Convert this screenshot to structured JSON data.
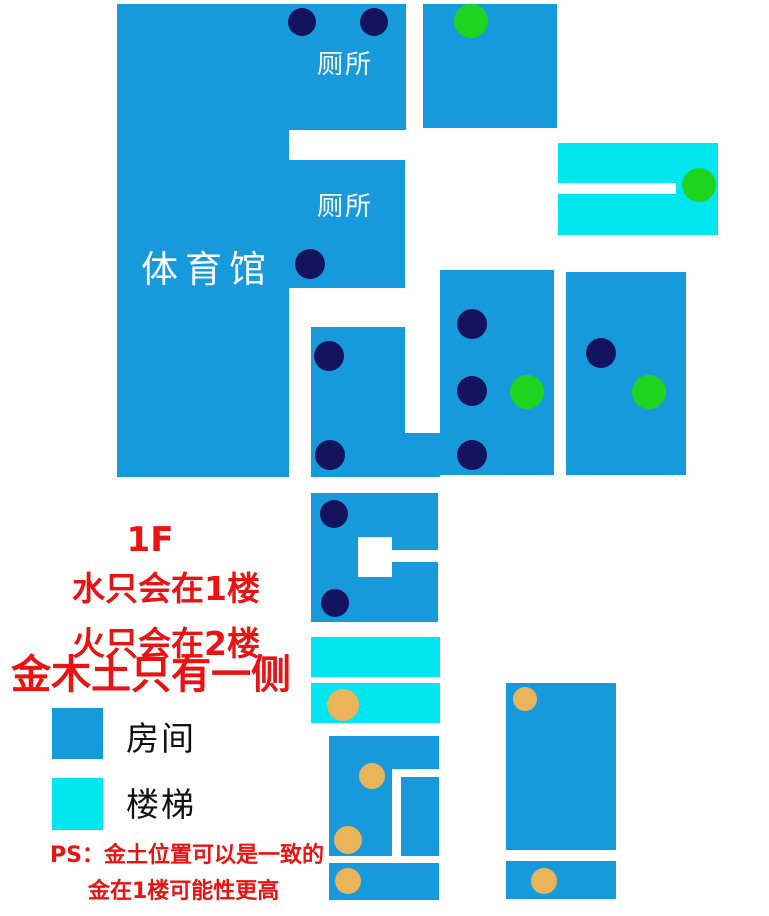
{
  "map": {
    "width": 769,
    "height": 916,
    "colors": {
      "room": "#169ADB",
      "stair": "#00E6EF",
      "cutout": "#FFFFFF",
      "navy": "#14145E",
      "green": "#1ED41E",
      "orange": "#E9B45A",
      "note_red": "#EA1212",
      "label_white": "#FFFFFF",
      "label_black": "#111111"
    },
    "labels": {
      "gym": "体育馆",
      "toilet_top": "厕所",
      "toilet_mid": "厕所"
    },
    "shapes": [
      {
        "name": "room-gym-main",
        "fill": "room",
        "x": 117,
        "y": 4,
        "w": 172,
        "h": 473
      },
      {
        "name": "room-gym-wing-top",
        "fill": "room",
        "x": 289,
        "y": 4,
        "w": 117,
        "h": 126
      },
      {
        "name": "room-gym-wing-mid",
        "fill": "room",
        "x": 289,
        "y": 160,
        "w": 116,
        "h": 128
      },
      {
        "name": "room-top-right",
        "fill": "room",
        "x": 423,
        "y": 4,
        "w": 134,
        "h": 124
      },
      {
        "name": "stair-top-right",
        "fill": "stair",
        "x": 558,
        "y": 143,
        "w": 160,
        "h": 92
      },
      {
        "name": "room-mid-left",
        "fill": "room",
        "x": 311,
        "y": 327,
        "w": 129,
        "h": 150
      },
      {
        "name": "room-mid-center",
        "fill": "room",
        "x": 440,
        "y": 270,
        "w": 114,
        "h": 205
      },
      {
        "name": "room-mid-right",
        "fill": "room",
        "x": 566,
        "y": 272,
        "w": 120,
        "h": 203
      },
      {
        "name": "room-lower-left",
        "fill": "room",
        "x": 311,
        "y": 493,
        "w": 127,
        "h": 129
      },
      {
        "name": "stair-mid-upper",
        "fill": "stair",
        "x": 311,
        "y": 637,
        "w": 129,
        "h": 40
      },
      {
        "name": "stair-mid-lower",
        "fill": "stair",
        "x": 311,
        "y": 683,
        "w": 129,
        "h": 40
      },
      {
        "name": "room-bottom-left",
        "fill": "room",
        "x": 329,
        "y": 736,
        "w": 110,
        "h": 120
      },
      {
        "name": "room-bottom-left-strip",
        "fill": "room",
        "x": 329,
        "y": 863,
        "w": 110,
        "h": 37
      },
      {
        "name": "room-bottom-right",
        "fill": "room",
        "x": 506,
        "y": 683,
        "w": 110,
        "h": 167
      },
      {
        "name": "room-bottom-right-strip",
        "fill": "room",
        "x": 506,
        "y": 861,
        "w": 110,
        "h": 38
      },
      {
        "name": "cutout-mid-left-channel",
        "fill": "cutout",
        "x": 405,
        "y": 327,
        "w": 35,
        "h": 106
      },
      {
        "name": "cutout-stair-slot",
        "fill": "cutout",
        "x": 558,
        "y": 183,
        "w": 118,
        "h": 11
      },
      {
        "name": "cutout-lower-left-square",
        "fill": "cutout",
        "x": 358,
        "y": 537,
        "w": 34,
        "h": 40
      },
      {
        "name": "cutout-lower-left-slot",
        "fill": "cutout",
        "x": 392,
        "y": 550,
        "w": 46,
        "h": 12
      },
      {
        "name": "cutout-bottom-left-slot-h",
        "fill": "cutout",
        "x": 392,
        "y": 769,
        "w": 47,
        "h": 8
      },
      {
        "name": "cutout-bottom-left-slot-v",
        "fill": "cutout",
        "x": 392,
        "y": 777,
        "w": 9,
        "h": 79
      }
    ],
    "dots": [
      {
        "name": "navy-dot",
        "color": "navy",
        "cx": 302,
        "cy": 22,
        "r": 14
      },
      {
        "name": "navy-dot",
        "color": "navy",
        "cx": 374,
        "cy": 22,
        "r": 14
      },
      {
        "name": "navy-dot",
        "color": "navy",
        "cx": 310,
        "cy": 264,
        "r": 15
      },
      {
        "name": "navy-dot",
        "color": "navy",
        "cx": 329,
        "cy": 356,
        "r": 15
      },
      {
        "name": "navy-dot",
        "color": "navy",
        "cx": 330,
        "cy": 455,
        "r": 15
      },
      {
        "name": "navy-dot",
        "color": "navy",
        "cx": 472,
        "cy": 324,
        "r": 15
      },
      {
        "name": "navy-dot",
        "color": "navy",
        "cx": 472,
        "cy": 391,
        "r": 15
      },
      {
        "name": "navy-dot",
        "color": "navy",
        "cx": 472,
        "cy": 455,
        "r": 15
      },
      {
        "name": "navy-dot",
        "color": "navy",
        "cx": 601,
        "cy": 353,
        "r": 15
      },
      {
        "name": "navy-dot",
        "color": "navy",
        "cx": 334,
        "cy": 514,
        "r": 14
      },
      {
        "name": "navy-dot",
        "color": "navy",
        "cx": 335,
        "cy": 603,
        "r": 14
      },
      {
        "name": "green-dot",
        "color": "green",
        "cx": 471,
        "cy": 21,
        "r": 17
      },
      {
        "name": "green-dot",
        "color": "green",
        "cx": 699,
        "cy": 185,
        "r": 17
      },
      {
        "name": "green-dot",
        "color": "green",
        "cx": 527,
        "cy": 392,
        "r": 17
      },
      {
        "name": "green-dot",
        "color": "green",
        "cx": 649,
        "cy": 392,
        "r": 17
      },
      {
        "name": "orange-dot",
        "color": "orange",
        "cx": 343,
        "cy": 705,
        "r": 16
      },
      {
        "name": "orange-dot",
        "color": "orange",
        "cx": 525,
        "cy": 699,
        "r": 12
      },
      {
        "name": "orange-dot",
        "color": "orange",
        "cx": 372,
        "cy": 776,
        "r": 13
      },
      {
        "name": "orange-dot",
        "color": "orange",
        "cx": 348,
        "cy": 840,
        "r": 14
      },
      {
        "name": "orange-dot",
        "color": "orange",
        "cx": 348,
        "cy": 881,
        "r": 13
      },
      {
        "name": "orange-dot",
        "color": "orange",
        "cx": 544,
        "cy": 881,
        "r": 13
      }
    ]
  },
  "notes": {
    "floor": "1F",
    "water": "水只会在1楼",
    "fire": "火只会在2楼",
    "elements": "金木土只有一侧",
    "ps1": "PS：金土位置可以是一致的",
    "ps2": "金在1楼可能性更高"
  },
  "legend": {
    "room": "房间",
    "stair": "楼梯"
  }
}
